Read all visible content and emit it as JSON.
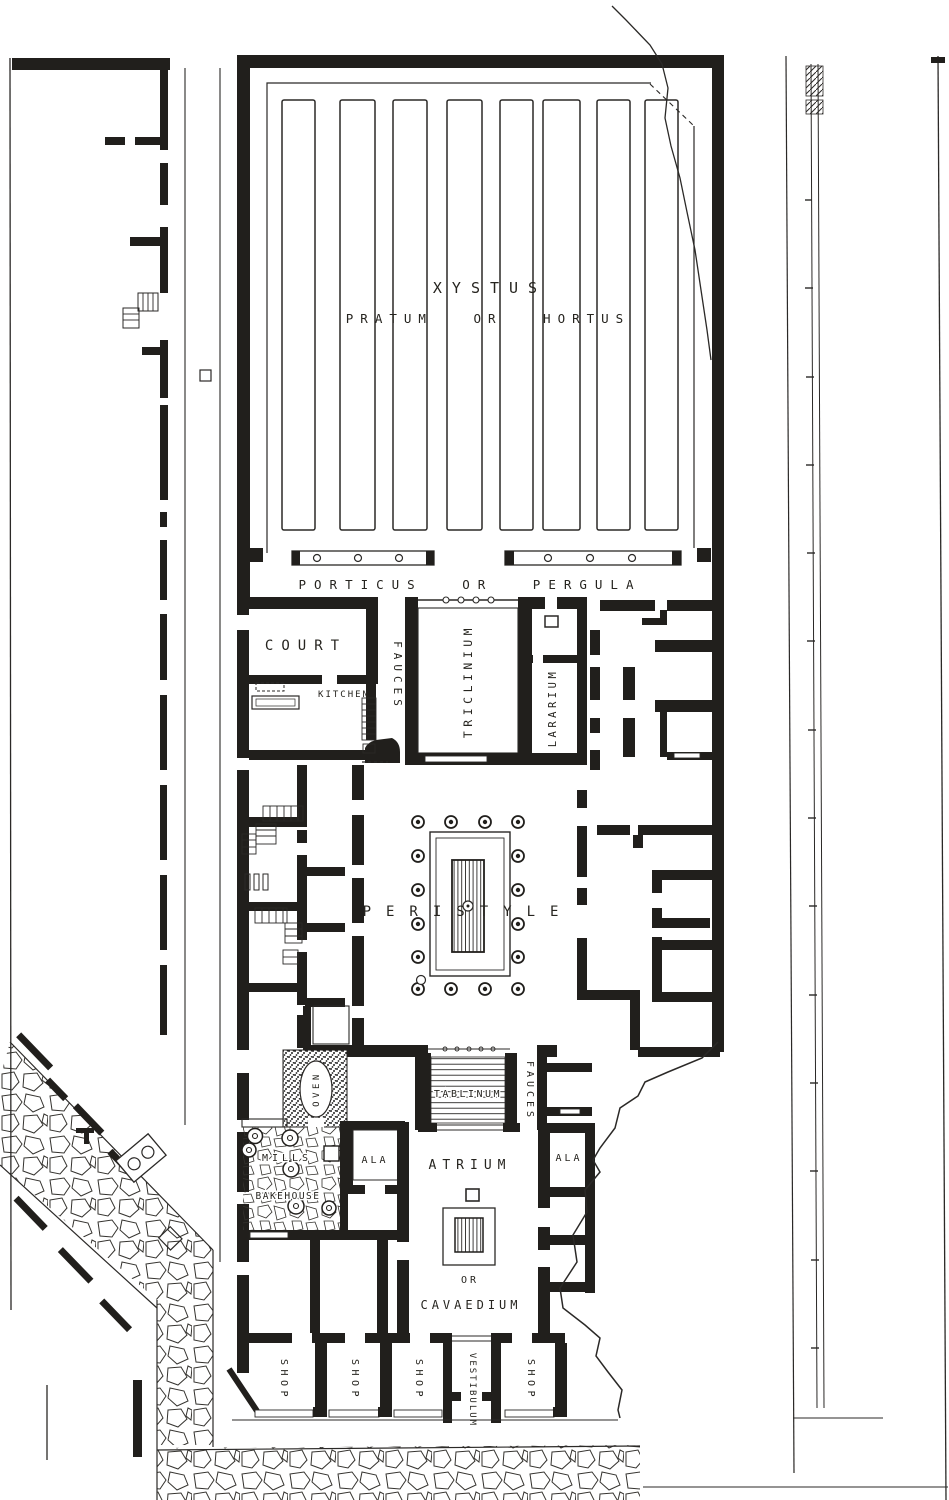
{
  "plan": {
    "ink_color": "#211f1c",
    "paper_color": "#ffffff",
    "labels": {
      "xystus": "XYSTUS",
      "pratum_or_hortus": "PRATUM OR HORTUS",
      "porticus_or_pergula": "PORTICUS OR PERGULA",
      "court": "COURT",
      "kitchen": "KITCHEN",
      "fauces_north": "FAUCES",
      "triclinium": "TRICLINIUM",
      "lararium": "LARARIUM",
      "peristyle": "PERISTYLE",
      "oven": "OVEN",
      "mills": "MILLS",
      "bakehouse": "BAKEHOUSE",
      "ala_west": "ALA",
      "ala_east": "ALA",
      "atrium": "ATRIUM",
      "tablinum": "TABLINUM",
      "fauces_south": "FAUCES",
      "or_word": "OR",
      "cavaedium": "CAVAEDIUM",
      "shop_1": "SHOP",
      "shop_2": "SHOP",
      "shop_3": "SHOP",
      "shop_4": "SHOP",
      "vestibulum": "VESTIBULUM"
    }
  }
}
